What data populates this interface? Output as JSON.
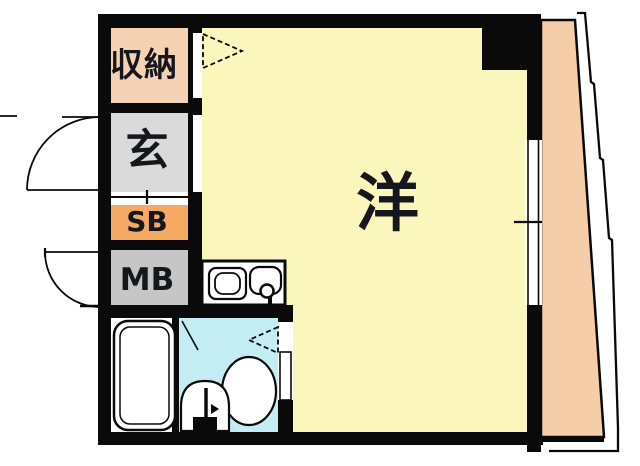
{
  "plan": {
    "background": "#FFFFFF",
    "wall_color": "#0A0A0A",
    "line_color": "#0A0A0A",
    "rooms": {
      "storage": {
        "label": "収納",
        "color": "#F6D2B4"
      },
      "entrance": {
        "label": "玄",
        "color": "#DADADA"
      },
      "shoe_box": {
        "label": "SB",
        "color": "#F5A963"
      },
      "meter_box": {
        "label": "MB",
        "color": "#C6C6C6"
      },
      "western_room": {
        "label": "洋",
        "color": "#FBF7BC"
      },
      "toilet_room": {
        "color": "#C3EDF3"
      },
      "bathroom": {
        "color": "#FFFFFF"
      },
      "balcony": {
        "label": "バルコニー",
        "color": "#F6CDA9"
      }
    },
    "fixtures": [
      "bathtub",
      "toilet",
      "washbasin",
      "kitchen-sink",
      "stove-burner"
    ],
    "symbols": [
      "entrance-door-swing",
      "meterbox-door-swing",
      "closet-door-arrow",
      "bathroom-door-arrow",
      "window-sliding-door"
    ]
  }
}
